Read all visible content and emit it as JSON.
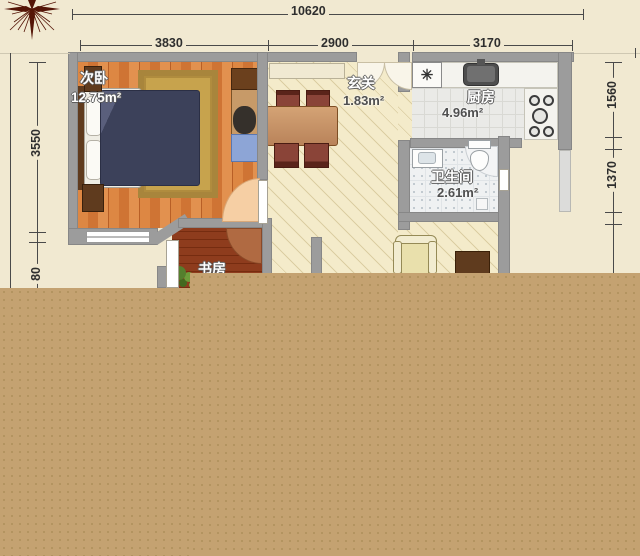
{
  "plan": {
    "compass": "compass-rose",
    "dimensions": {
      "top_total": "10620",
      "top_segments": [
        "3830",
        "2900",
        "3170"
      ],
      "left_segments": [
        "3550",
        "80"
      ],
      "right_segments": [
        "1560",
        "1370"
      ]
    },
    "rooms": {
      "bedroom": {
        "name": "次卧",
        "area": "12.75m²"
      },
      "hall": {
        "name": "玄关",
        "area": "1.83m²"
      },
      "kitchen": {
        "name": "厨房",
        "area": "4.96m²",
        "appliance_symbol": "✳"
      },
      "bathroom": {
        "name": "卫生间",
        "area": "2.61m²"
      },
      "study": {
        "name": "书房"
      }
    },
    "colors": {
      "overlay_block": "#c4a271",
      "wall": "#9c9c9c",
      "background": "#f1e9d1"
    }
  }
}
